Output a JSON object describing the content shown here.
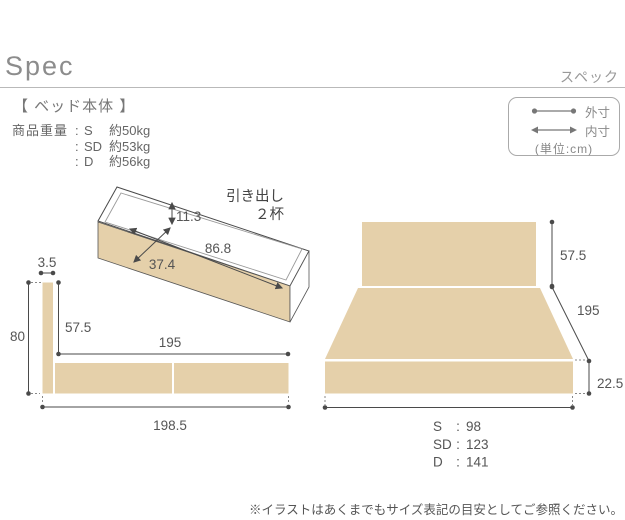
{
  "header": {
    "title": "Spec",
    "title_kana": "スペック"
  },
  "section_heading": "【 ベッド本体 】",
  "weight": {
    "rows": [
      {
        "label": "商品重量",
        "colon": ":",
        "size": "S",
        "value": "約50kg"
      },
      {
        "label": "",
        "colon": ":",
        "size": "SD",
        "value": "約53kg"
      },
      {
        "label": "",
        "colon": ":",
        "size": "D",
        "value": "約56kg"
      }
    ]
  },
  "legend": {
    "outer": "外寸",
    "inner": "内寸",
    "unit": "(単位:cm)"
  },
  "drawer": {
    "title_line1": "引き出し",
    "title_line2": "２杯",
    "depth": "11.3",
    "length": "86.8",
    "width": "37.4"
  },
  "side_view": {
    "headboard_thickness": "3.5",
    "total_height": "80",
    "headboard_above_base": "57.5",
    "inner_length": "195",
    "total_length": "198.5"
  },
  "front_view": {
    "headboard_height": "57.5",
    "depth": "195",
    "base_height": "22.5",
    "colon": ":",
    "widths": [
      {
        "size": "S",
        "value": "98"
      },
      {
        "size": "SD",
        "value": "123"
      },
      {
        "size": "D",
        "value": "141"
      }
    ]
  },
  "footnote": "※イラストはあくまでもサイズ表記の目安としてご参照ください。",
  "colors": {
    "wood": "#e5d0aa",
    "dimension_line": "#4a4a4a",
    "text_gray": "#888888"
  }
}
